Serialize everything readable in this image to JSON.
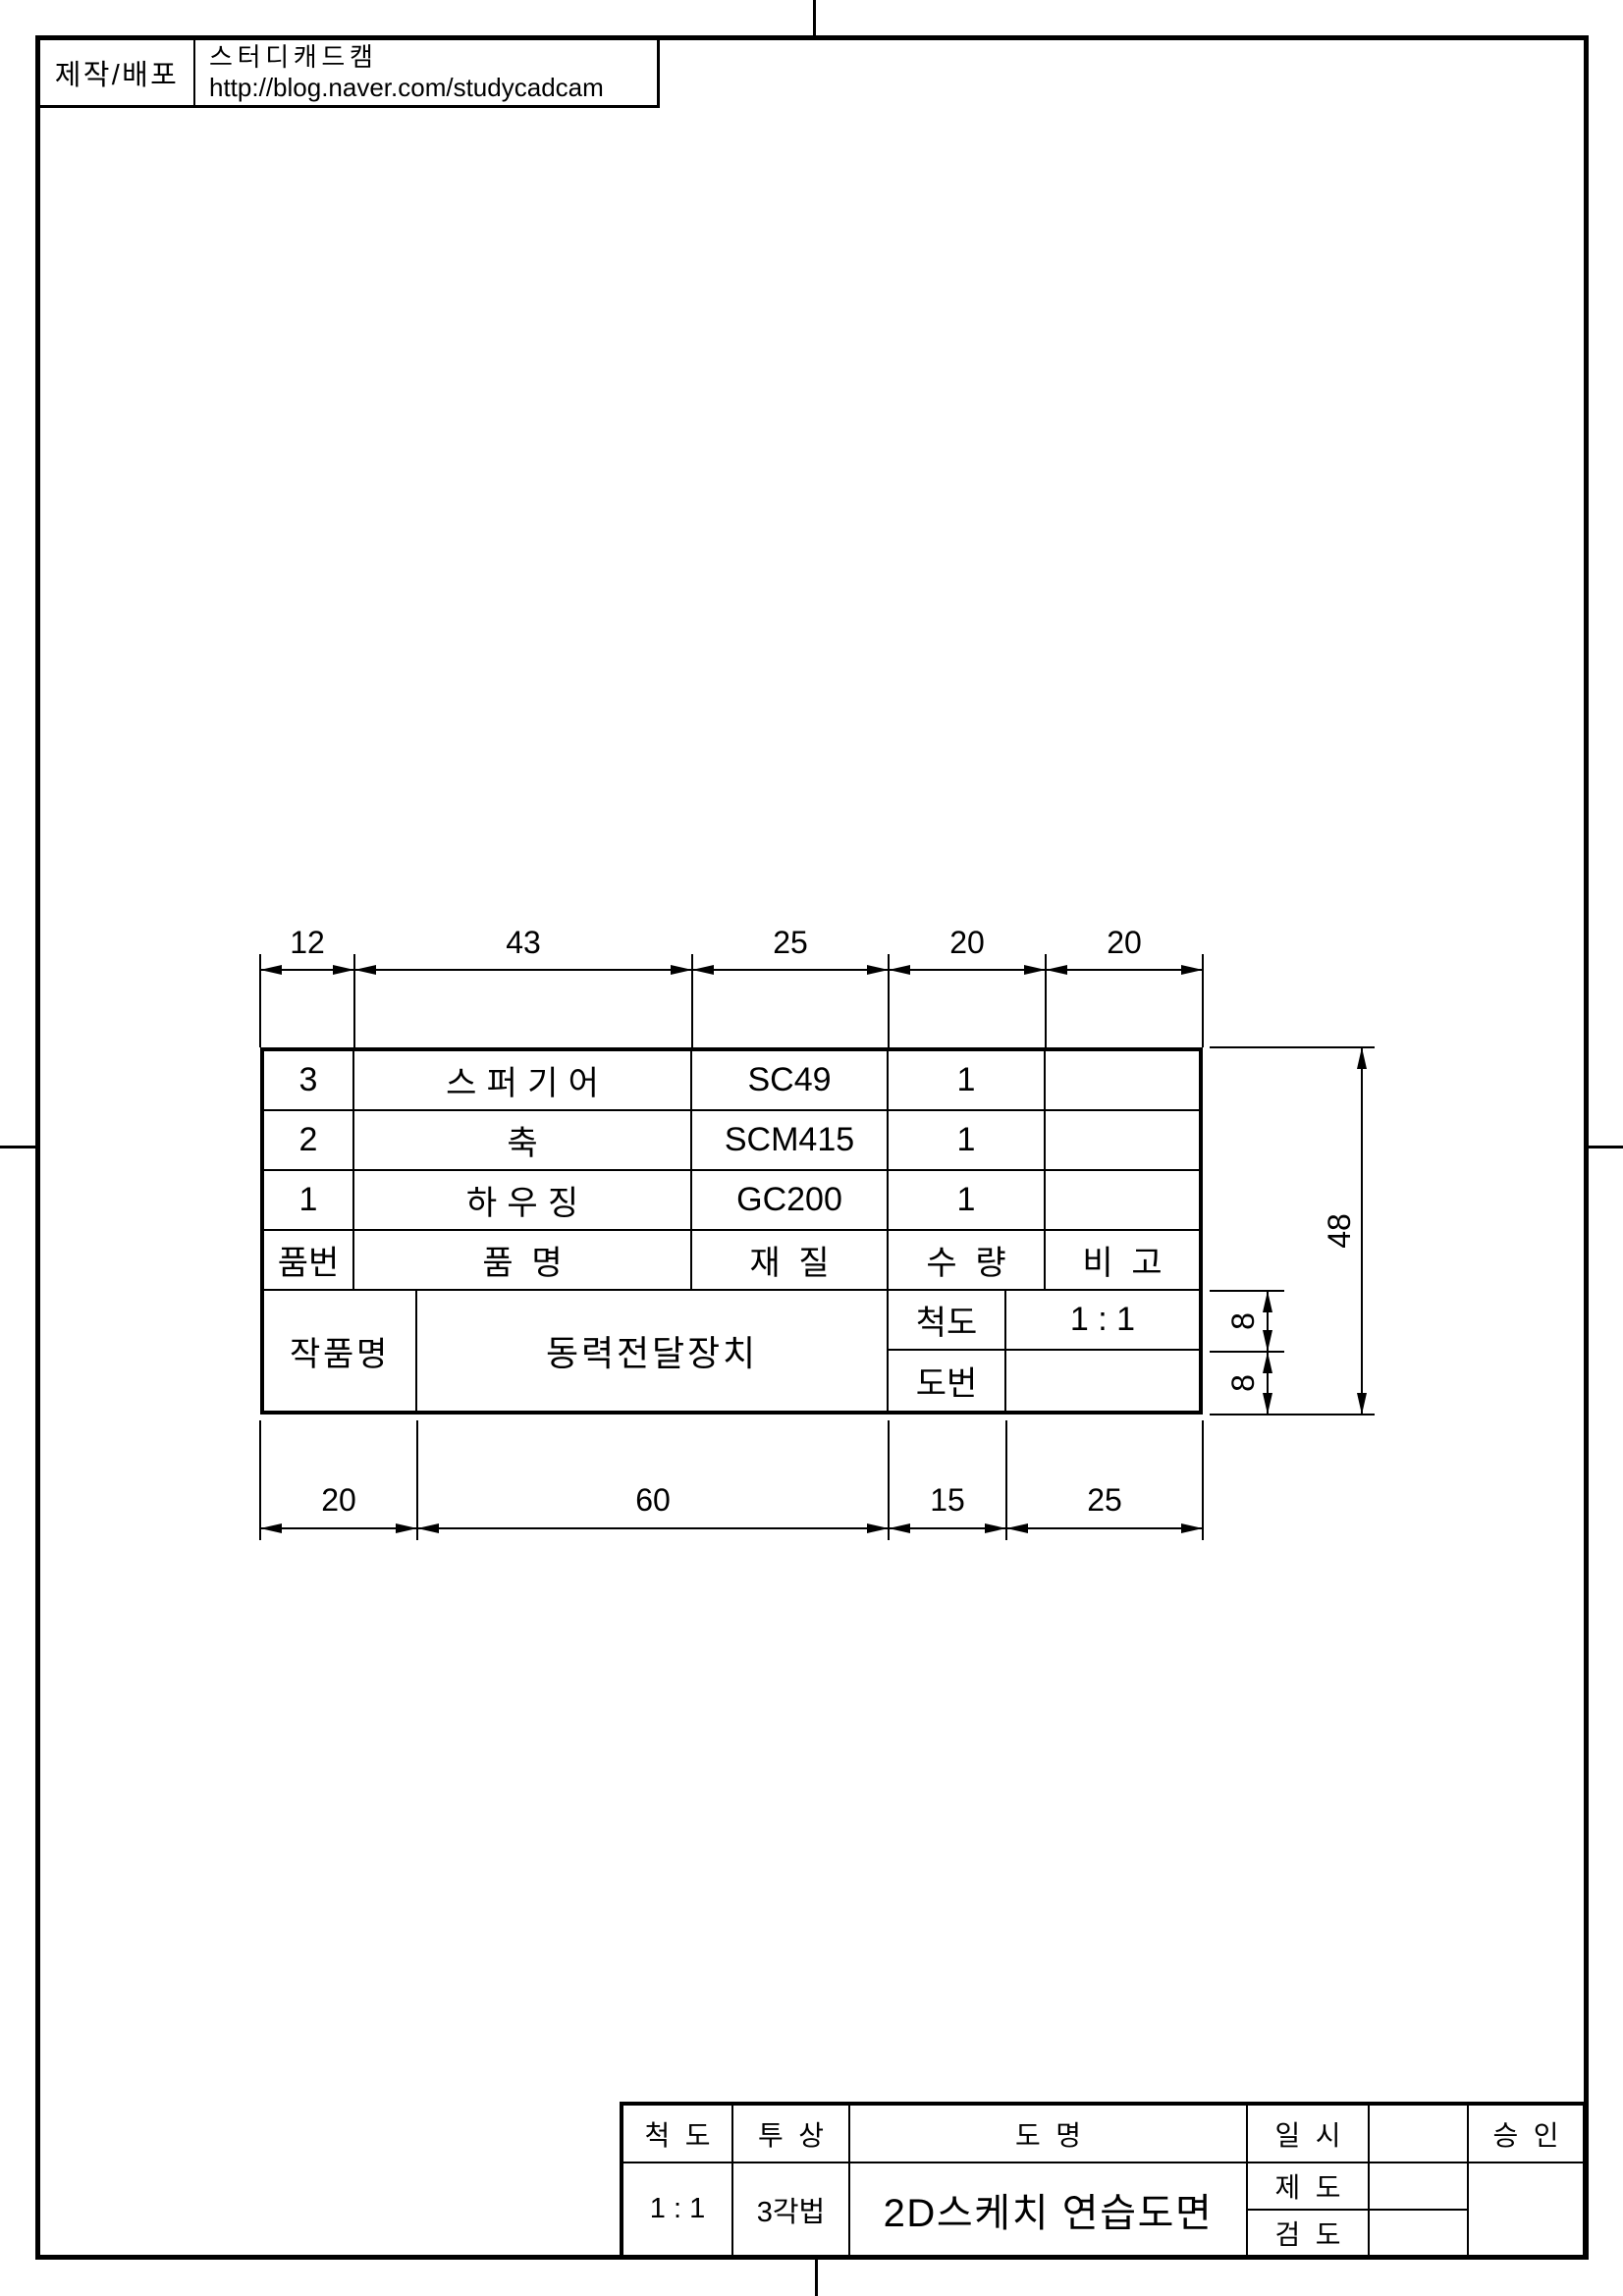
{
  "colors": {
    "ink": "#000000",
    "paper": "#ffffff"
  },
  "credit": {
    "label": "제작/배포",
    "brand": "스터디캐드캠",
    "url": "http://blog.naver.com/studycadcam"
  },
  "parts_table": {
    "rows": [
      {
        "no": "3",
        "name": "스퍼기어",
        "material": "SC49",
        "qty": "1",
        "note": ""
      },
      {
        "no": "2",
        "name": "축",
        "material": "SCM415",
        "qty": "1",
        "note": ""
      },
      {
        "no": "1",
        "name": "하우징",
        "material": "GC200",
        "qty": "1",
        "note": ""
      }
    ],
    "header": {
      "no": "품번",
      "name": "품명",
      "material": "재질",
      "qty": "수량",
      "note": "비고"
    },
    "footer": {
      "project_label": "작품명",
      "project_name": "동력전달장치",
      "scale_label": "척도",
      "scale_value": "1 : 1",
      "drawing_no_label": "도번",
      "drawing_no_value": ""
    }
  },
  "dimensions": {
    "top": [
      "12",
      "43",
      "25",
      "20",
      "20"
    ],
    "bottom": [
      "20",
      "60",
      "15",
      "25"
    ],
    "right_total": "48",
    "right_sub": [
      "8",
      "8"
    ]
  },
  "title_block": {
    "scale_label": "척도",
    "projection_label": "투상",
    "name_label": "도명",
    "date_label": "일시",
    "approval_label": "승인",
    "scale_value": "1 : 1",
    "projection_value": "3각법",
    "name_value": "2D스케치 연습도면",
    "date_value": "",
    "draft_label": "제도",
    "draft_value": "",
    "check_label": "검도",
    "check_value": "",
    "approval_value": ""
  }
}
